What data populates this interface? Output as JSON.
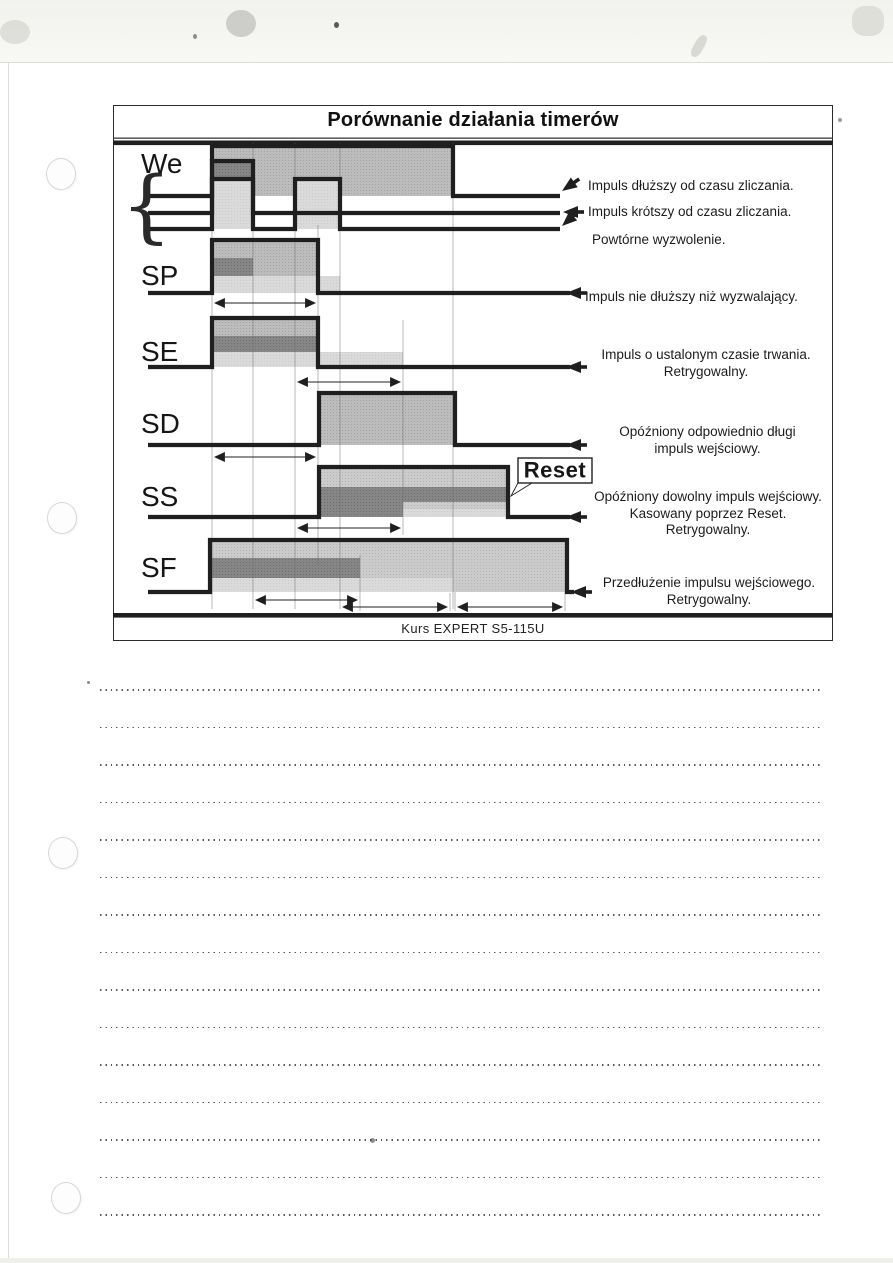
{
  "diagram": {
    "title": "Porównanie działania timerów",
    "footer": "Kurs EXPERT S5-115U",
    "reset_label": "Reset",
    "signals": [
      {
        "label": "We"
      },
      {
        "label": "SP"
      },
      {
        "label": "SE"
      },
      {
        "label": "SD"
      },
      {
        "label": "SS"
      },
      {
        "label": "SF"
      }
    ],
    "annotations": {
      "we_long": "Impuls dłuższy od czasu zliczania.",
      "we_short": "Impuls krótszy od czasu zliczania.",
      "we_retrigger": "Powtórne wyzwolenie.",
      "sp": "Impuls nie dłuższy niż wyzwalający.",
      "se_line1": "Impuls o ustalonym czasie trwania.",
      "se_line2": "Retrygowalny.",
      "sd_line1": "Opóźniony odpowiednio długi",
      "sd_line2": "impuls wejściowy.",
      "ss_line1": "Opóźniony dowolny impuls wejściowy.",
      "ss_line2": "Kasowany poprzez Reset.",
      "ss_line3": "Retrygowalny.",
      "sf_line1": "Przedłużenie impulsu wejściowego.",
      "sf_line2": "Retrygowalny."
    },
    "colors": {
      "line": "#1f1f1f",
      "fill_medium": "#bcbcbc",
      "fill_dark": "#868686",
      "fill_light": "#dadada",
      "fill_soft": "#cbcbcb"
    }
  },
  "notes": {
    "count": 15
  }
}
